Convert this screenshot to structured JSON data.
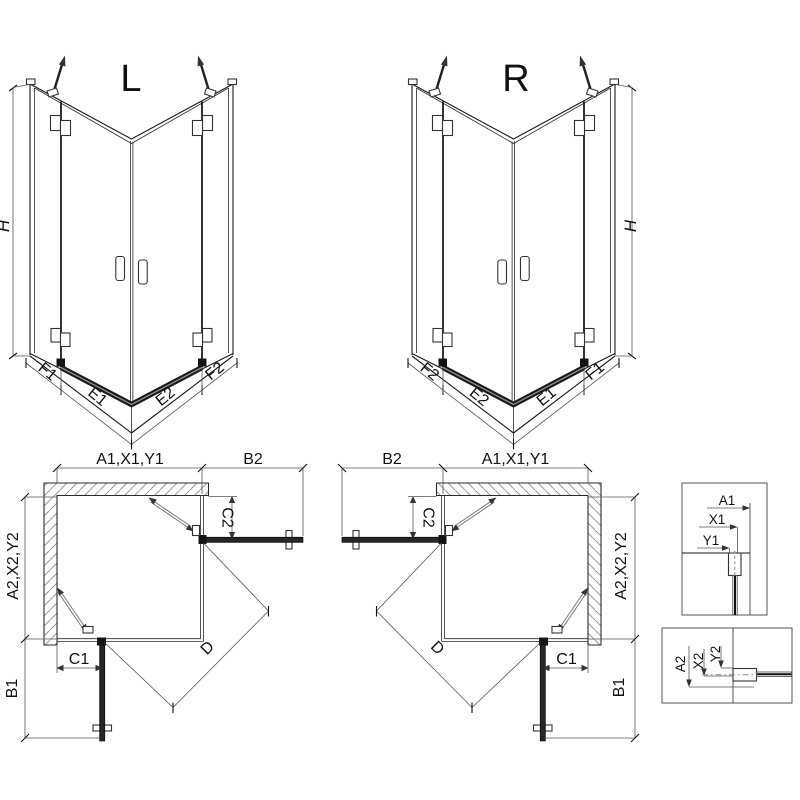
{
  "colors": {
    "ink": "#1a1a1a",
    "dim_line": "#555555",
    "hatch": "#999999",
    "door_panel": "#262626"
  },
  "persp_left": {
    "title": "L",
    "height": "H",
    "fixed1": "F1",
    "door1": "E1",
    "door2": "E2",
    "fixed2": "F2"
  },
  "persp_right": {
    "title": "R",
    "height": "H",
    "fixed1": "F1",
    "door1": "E1",
    "door2": "E2",
    "fixed2": "F2"
  },
  "plan_left": {
    "a1": "A1,X1,Y1",
    "b2": "B2",
    "c2": "C2",
    "a2": "A2,X2,Y2",
    "c1": "C1",
    "b1": "B1",
    "d": "D"
  },
  "plan_right": {
    "a1": "A1,X1,Y1",
    "b2": "B2",
    "c2": "C2",
    "a2": "A2,X2,Y2",
    "c1": "C1",
    "b1": "B1",
    "d": "D"
  },
  "detail_top": {
    "a1": "A1",
    "x1": "X1",
    "y1": "Y1"
  },
  "detail_bottom": {
    "a2": "A2",
    "x2": "X2",
    "y2": "Y2"
  }
}
